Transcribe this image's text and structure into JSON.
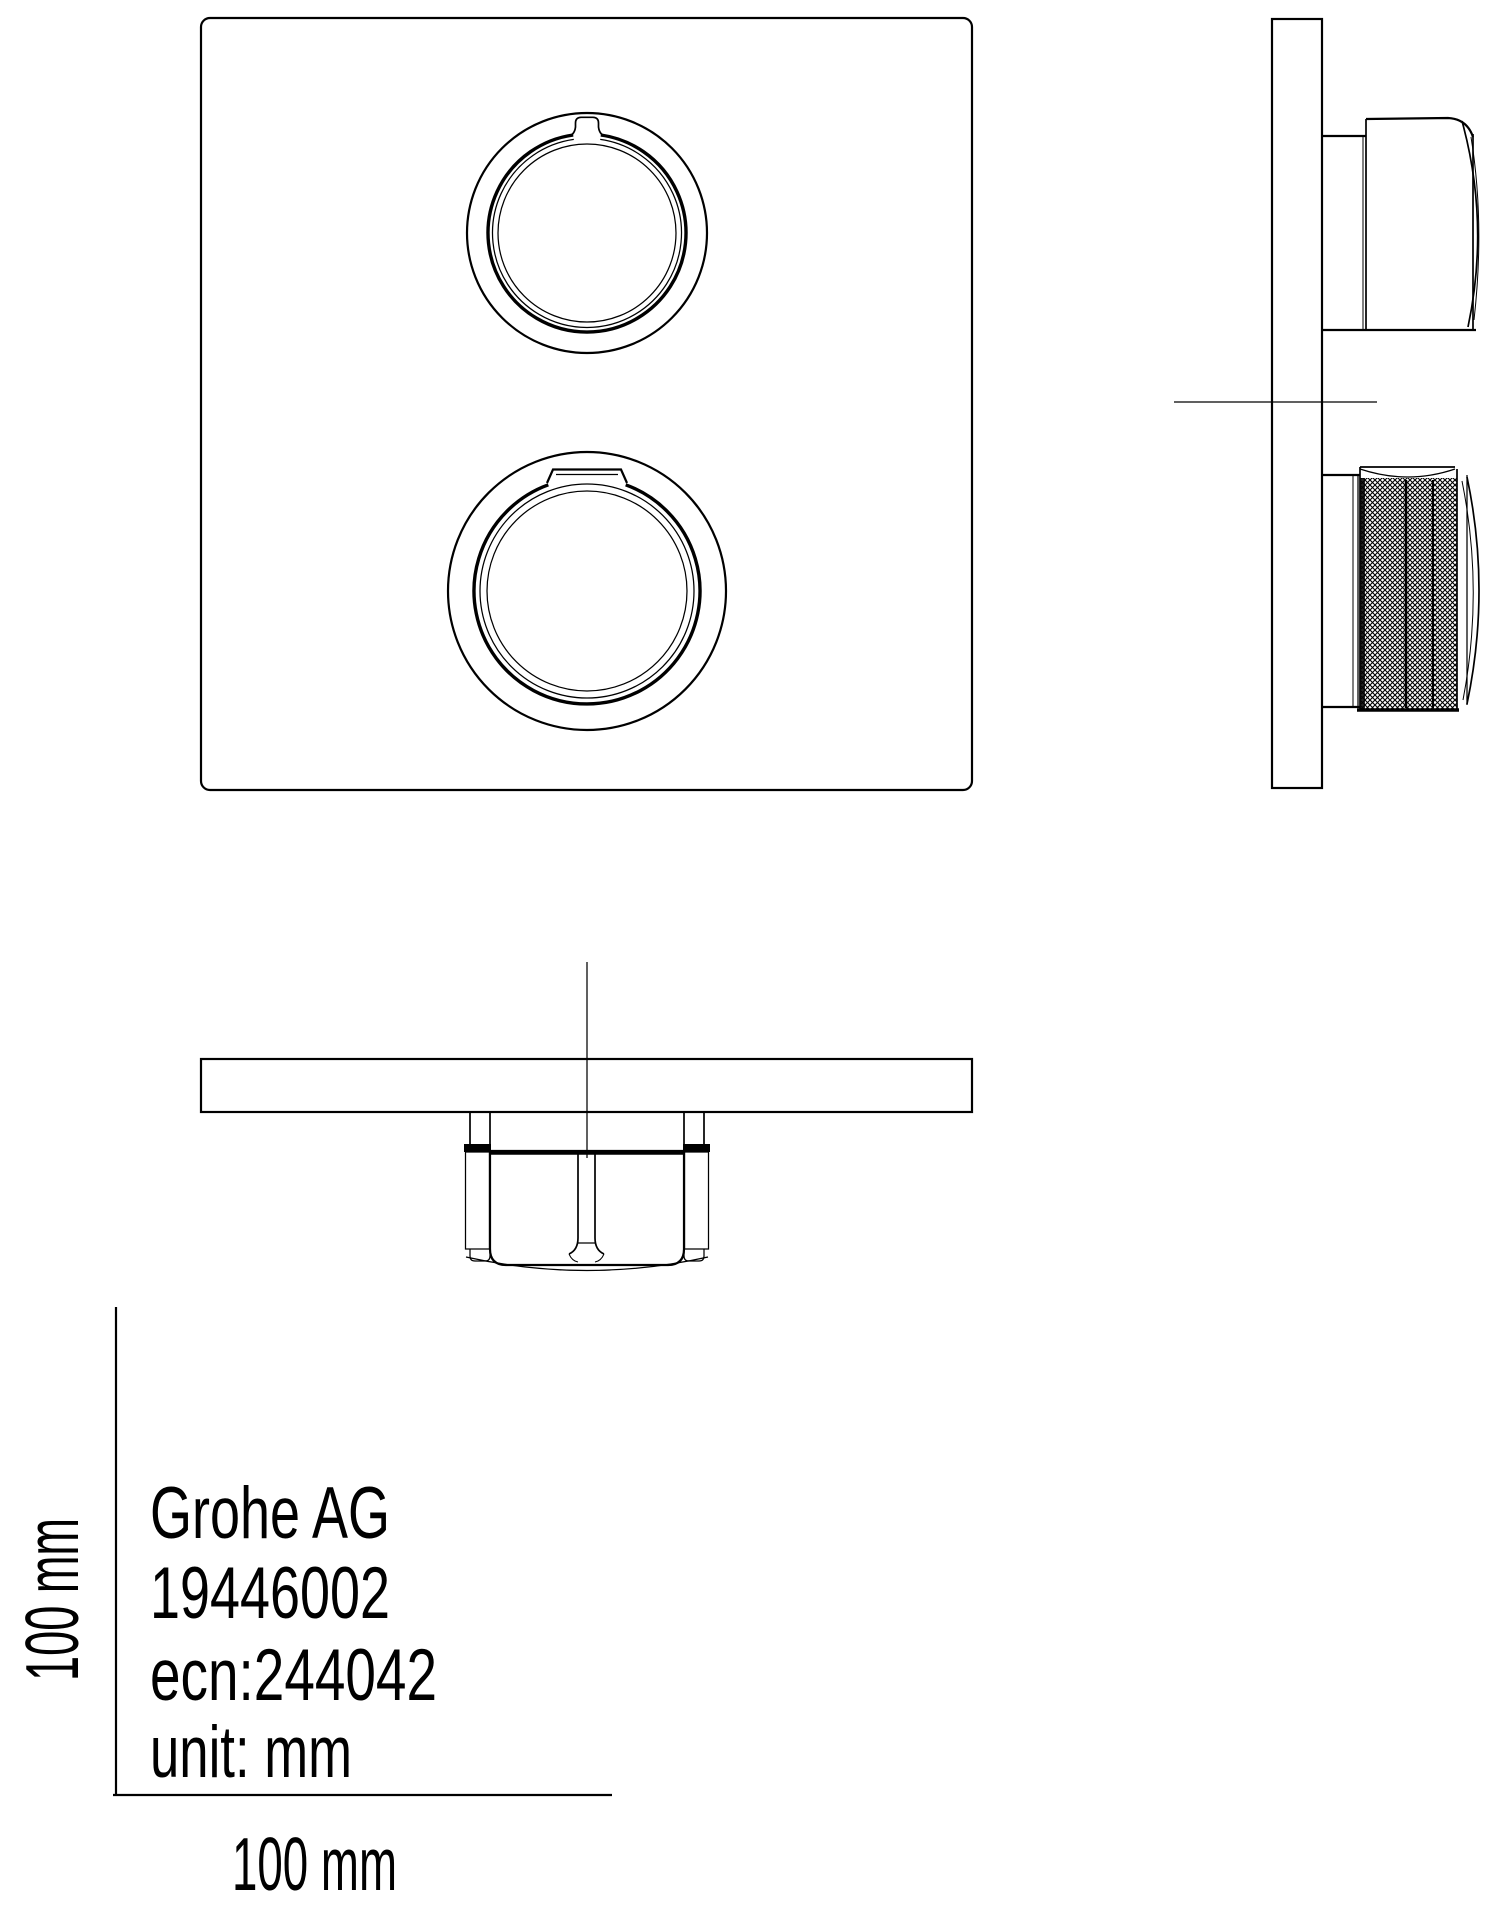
{
  "colors": {
    "ink": "#000000",
    "background": "#ffffff"
  },
  "title_block": {
    "manufacturer": "Grohe AG",
    "product_number": "19446002",
    "ecn": "ecn:244042",
    "unit": "unit: mm"
  },
  "dimensions": {
    "height_label": "100 mm",
    "width_label": "100 mm"
  }
}
